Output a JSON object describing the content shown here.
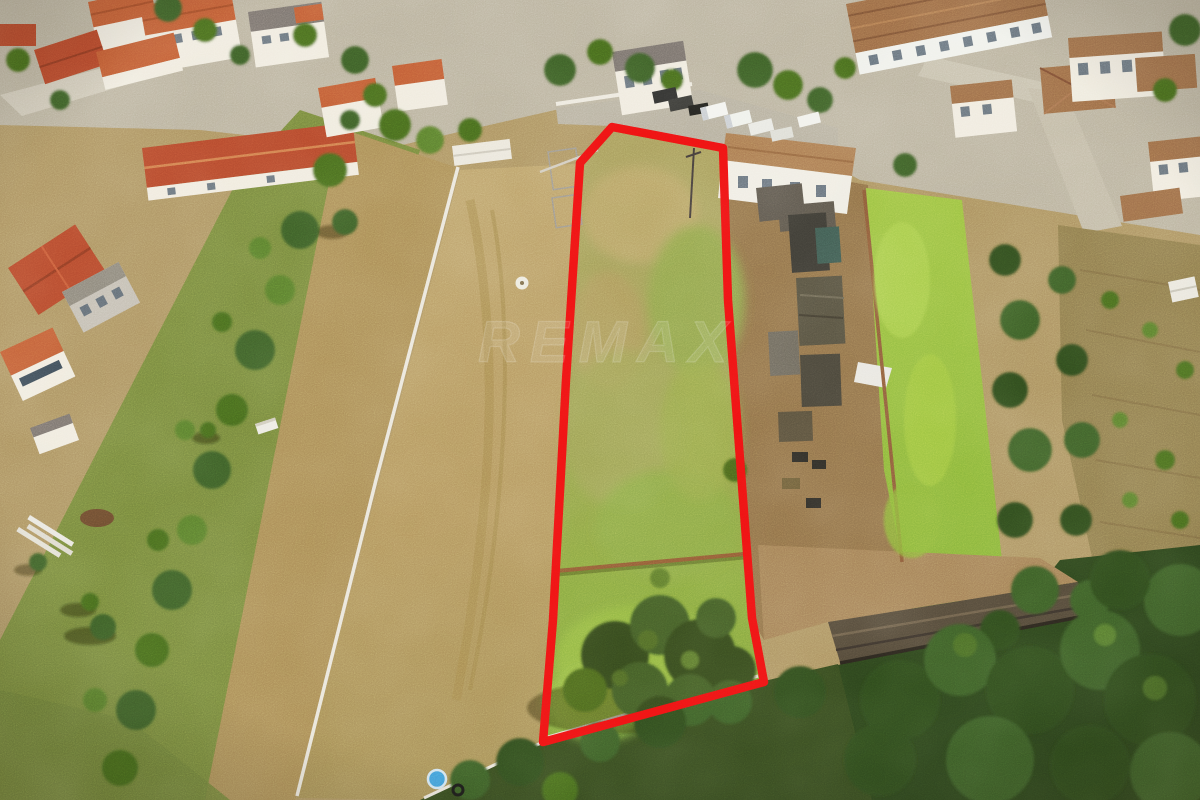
{
  "scene": {
    "description": "Aerial drone photograph of a rural village; a long trapezoidal land plot is highlighted with a red boundary line, flanked by a plowed dirt field, sheds, green paddocks, gardens and orange-roofed houses",
    "watermark": {
      "text": "REMAX"
    }
  },
  "plot_outline": {
    "points": "612,127 723,148 728,300 752,618 764,682 543,742 553,620 566,380 580,163",
    "color": "#ee1111",
    "stroke_width": 8.5
  },
  "palette": {
    "dirt_field": "#b59a61",
    "left_strip": "#a98b55",
    "plot_meadow_top": "#a6a05e",
    "plot_meadow_bottom": "#82ab3e",
    "bright_green_field": "#93ba3d",
    "dark_trees": "#2d481d",
    "roof_orange": "#bf5a33",
    "roof_red": "#b3472b",
    "roof_brown": "#9a6a45",
    "road": "#b5ae9c",
    "wall_white": "#efeadd",
    "shed_dark": "#4a463c",
    "rust_wall": "#8a5a33",
    "pool_blue": "#3f9bd8"
  }
}
